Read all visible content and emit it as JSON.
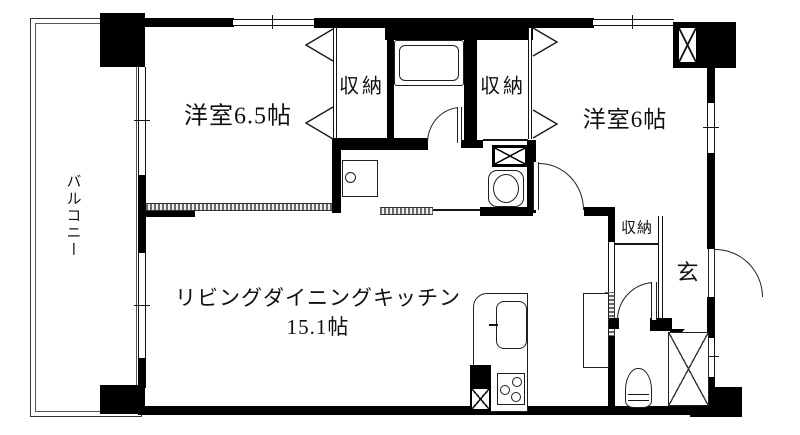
{
  "floorplan": {
    "type": "apartment-floor-plan",
    "colors": {
      "wall": "#000000",
      "line": "#1a1a1a",
      "background": "#ffffff",
      "hatch": "#6a6a6a"
    },
    "labels": {
      "balcony": "バルコニー",
      "bedroom_65": "洋室6.5帖",
      "closet_top_left": "収納",
      "closet_top_right": "収納",
      "bedroom_6": "洋室6帖",
      "ldk_line1": "リビングダイニングキッチン",
      "ldk_line2": "15.1帖",
      "hall_closet": "収納",
      "entrance": "玄"
    },
    "fixtures": [
      "bathtub",
      "bathroom-door",
      "bifold-closet-doors",
      "washing-machine-pan",
      "washbasin",
      "pipe-space",
      "bedroom-door",
      "hall-opening",
      "toilet-door",
      "entrance-door",
      "toilet",
      "refrigerator-space",
      "kitchen-counter",
      "kitchen-sink",
      "gas-stove",
      "duct-shaft",
      "windows"
    ]
  }
}
